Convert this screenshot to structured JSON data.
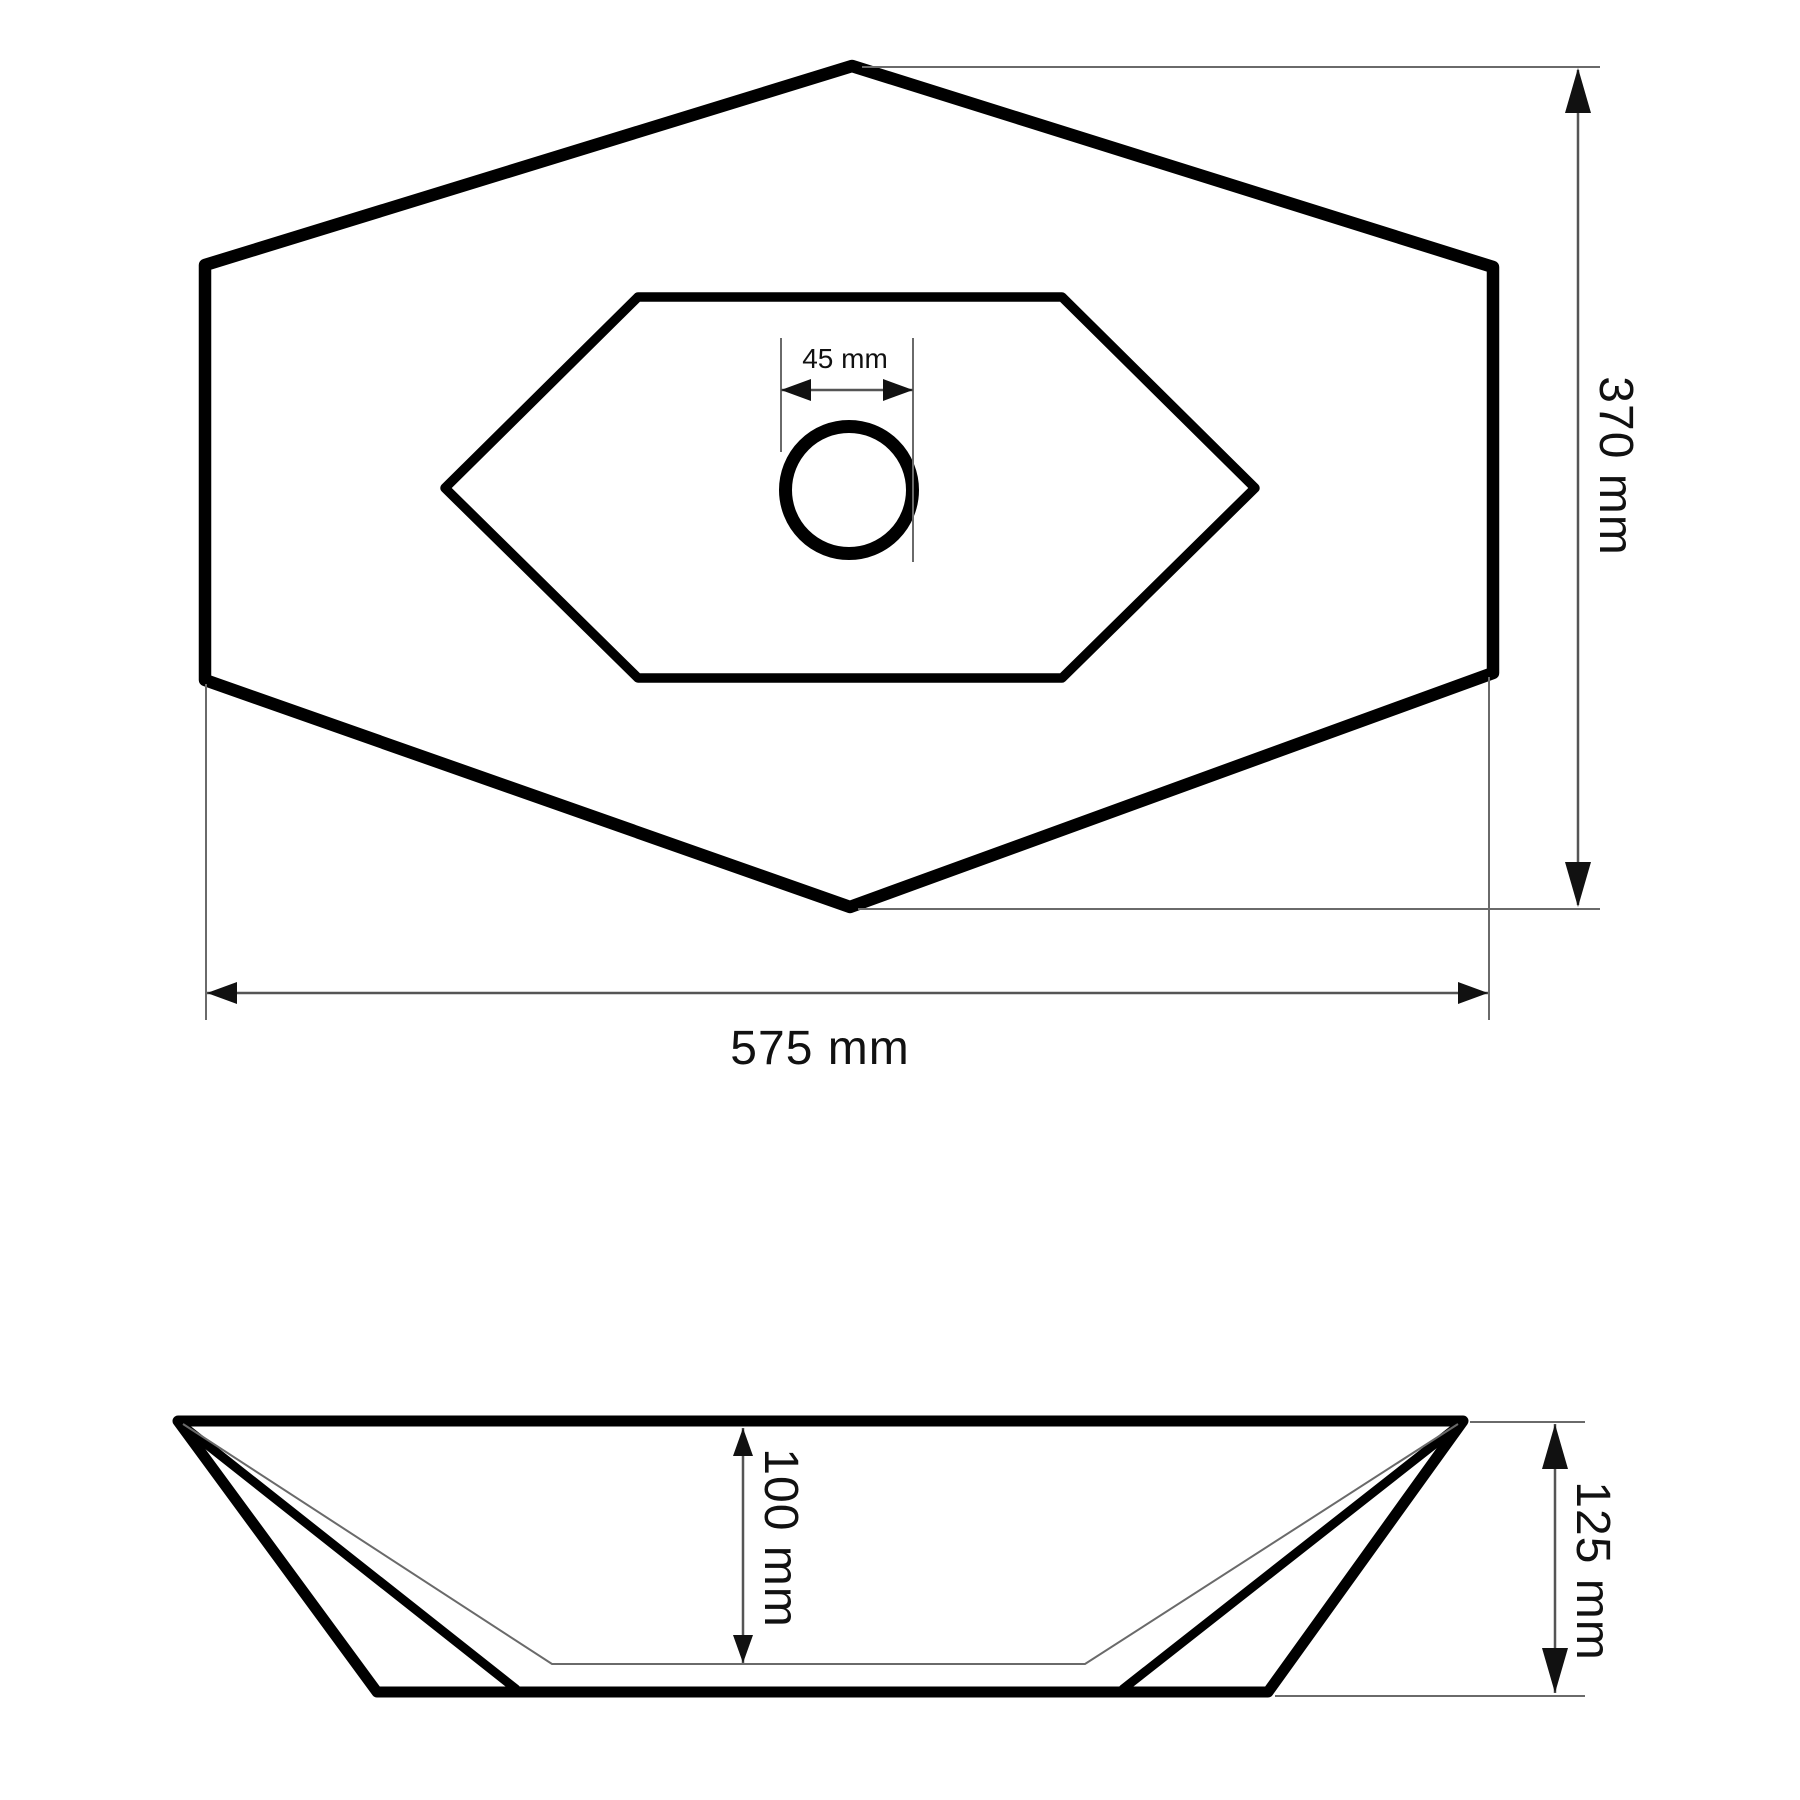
{
  "page": {
    "title": "Hexagonal washbasin technical drawing",
    "background": "#ffffff"
  },
  "colors": {
    "outline": "#000000",
    "dimension_line": "#555555",
    "extension_line": "#6a6a6a",
    "text": "#111111"
  },
  "top_view": {
    "drain_diameter_label": "45 mm",
    "depth_label": "370 mm",
    "width_label": "575 mm"
  },
  "side_view": {
    "inner_depth_label": "100 mm",
    "overall_height_label": "125 mm"
  },
  "dimensions_mm": {
    "width": 575,
    "depth": 370,
    "drain_diameter": 45,
    "inner_depth": 100,
    "overall_height": 125
  }
}
